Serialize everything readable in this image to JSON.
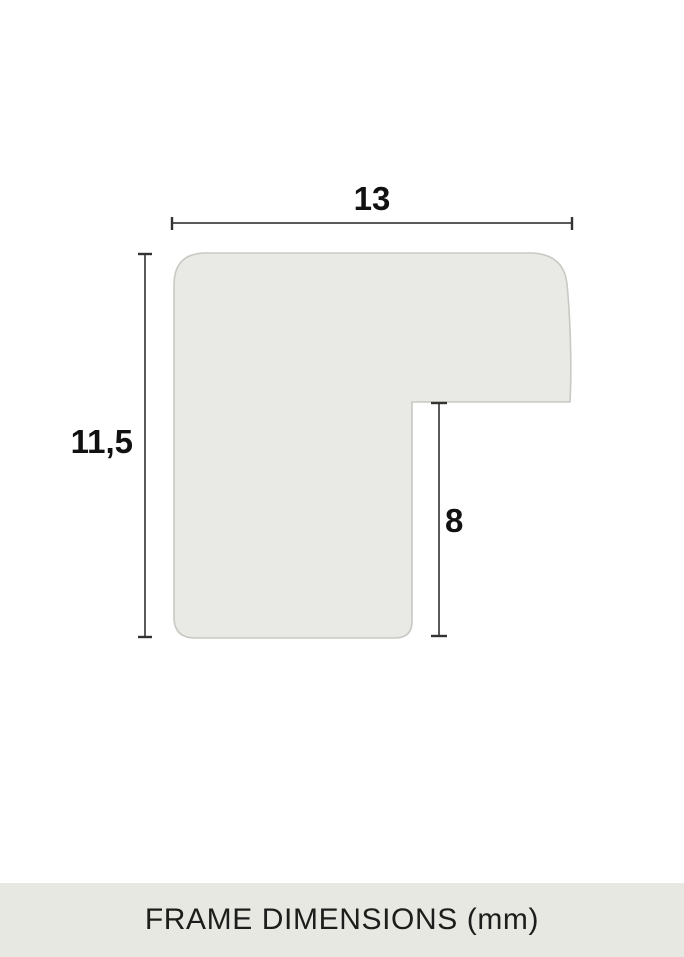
{
  "diagram": {
    "caption": "FRAME DIMENSIONS (mm)",
    "unit": "mm",
    "dimensions": {
      "width": {
        "label": "13",
        "value": 13
      },
      "height": {
        "label": "11,5",
        "value": 11.5
      },
      "rabbet_depth": {
        "label": "8",
        "value": 8
      }
    }
  },
  "colors": {
    "background": "#ffffff",
    "profile_fill": "#e9e9e5",
    "profile_stroke": "#c8c8c4",
    "dimension_line": "#5a5a5a",
    "dimension_tick": "#333333",
    "label_text": "#111111",
    "footer_background": "#e8e8e3",
    "footer_text": "#1d1d1b"
  }
}
